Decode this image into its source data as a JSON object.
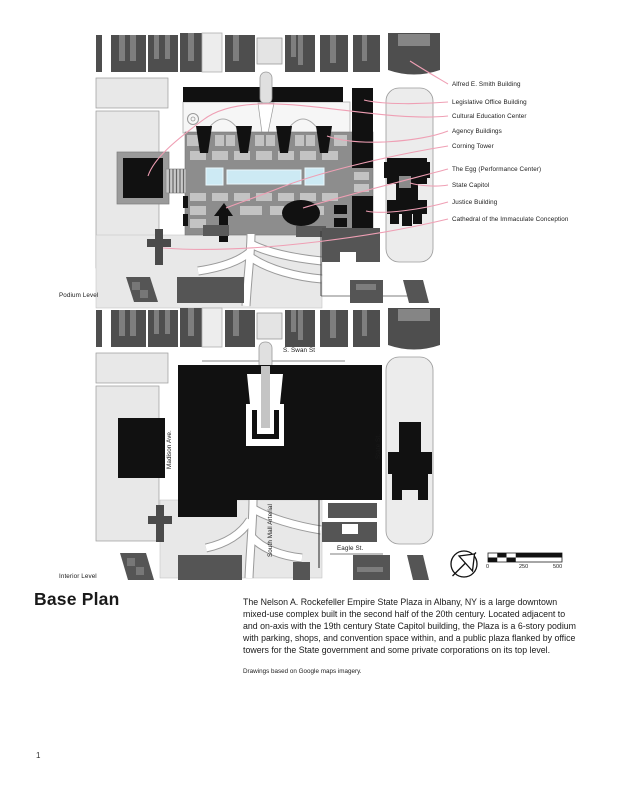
{
  "page": {
    "title": "Base Plan",
    "number": "1"
  },
  "levels": {
    "podium": "Podium Level",
    "interior": "Interior Level"
  },
  "legend": {
    "items": [
      "Alfred E. Smith Building",
      "Legislative Office Building",
      "Cultural Education Center",
      "Agency Buildings",
      "Corning Tower",
      "The Egg (Performance Center)",
      "State Capitol",
      "Justice Building",
      "Cathedral of the Immaculate Conception"
    ]
  },
  "streets": {
    "swan": "S. Swan St",
    "madison": "Madison Ave.",
    "state": "State St.",
    "eagle": "Eagle St.",
    "arterial": "South Mall Arterial"
  },
  "scale_bar": {
    "ticks": [
      "0",
      "250",
      "500"
    ]
  },
  "description": "The Nelson A. Rockefeller Empire State Plaza in Albany, NY is a large downtown mixed-use complex built in the second half of the 20th century. Located adjacent to and on-axis with the 19th century State Capitol building, the Plaza is a 6-story podium with parking, shops, and convention space within, and a public plaza flanked by office towers for the State government and some private corporations on its top level.",
  "credit": "Drawings based on Google maps imagery.",
  "icons": {
    "north_arrow": "north-arrow-icon"
  },
  "colors": {
    "leader": "#ef9fb4",
    "pool": "#cdeaf4",
    "pool_edge": "#e9f6fb",
    "podium": "#8d8d8d",
    "block_dark": "#4e4e4e",
    "ink": "#111111"
  }
}
